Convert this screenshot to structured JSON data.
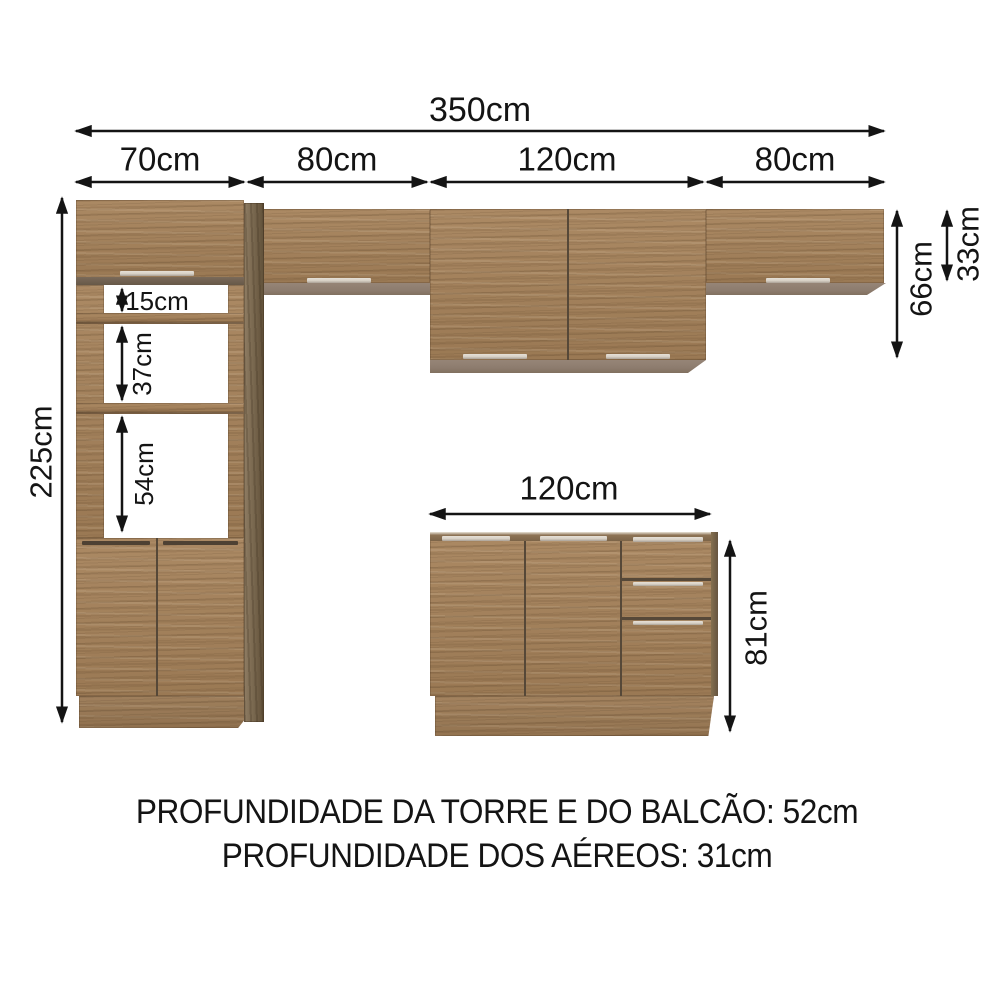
{
  "dimensions": {
    "total_width": "350cm",
    "segment_tower_width": "70cm",
    "segment_left_aereo_width": "80cm",
    "segment_mid_aereo_width": "120cm",
    "segment_right_aereo_width": "80cm",
    "tower_height": "225cm",
    "tower_opening_top": "15cm",
    "tower_opening_middle": "37cm",
    "tower_opening_bottom": "54cm",
    "aereo_tall_height": "66cm",
    "aereo_short_height": "33cm",
    "balcao_width": "120cm",
    "balcao_height": "81cm"
  },
  "footer": {
    "line1": "PROFUNDIDADE DA TORRE E DO BALCÃO: 52cm",
    "line2": "PROFUNDIDADE DOS AÉREOS: 31cm"
  },
  "colors": {
    "background": "#ffffff",
    "wood_face": "#a6825a",
    "wood_side": "#7c6749",
    "underside_gray": "#8d7c6e",
    "handle_light": "#d7d0c5",
    "slit_dark": "#564838",
    "arrow_black": "#141414"
  }
}
